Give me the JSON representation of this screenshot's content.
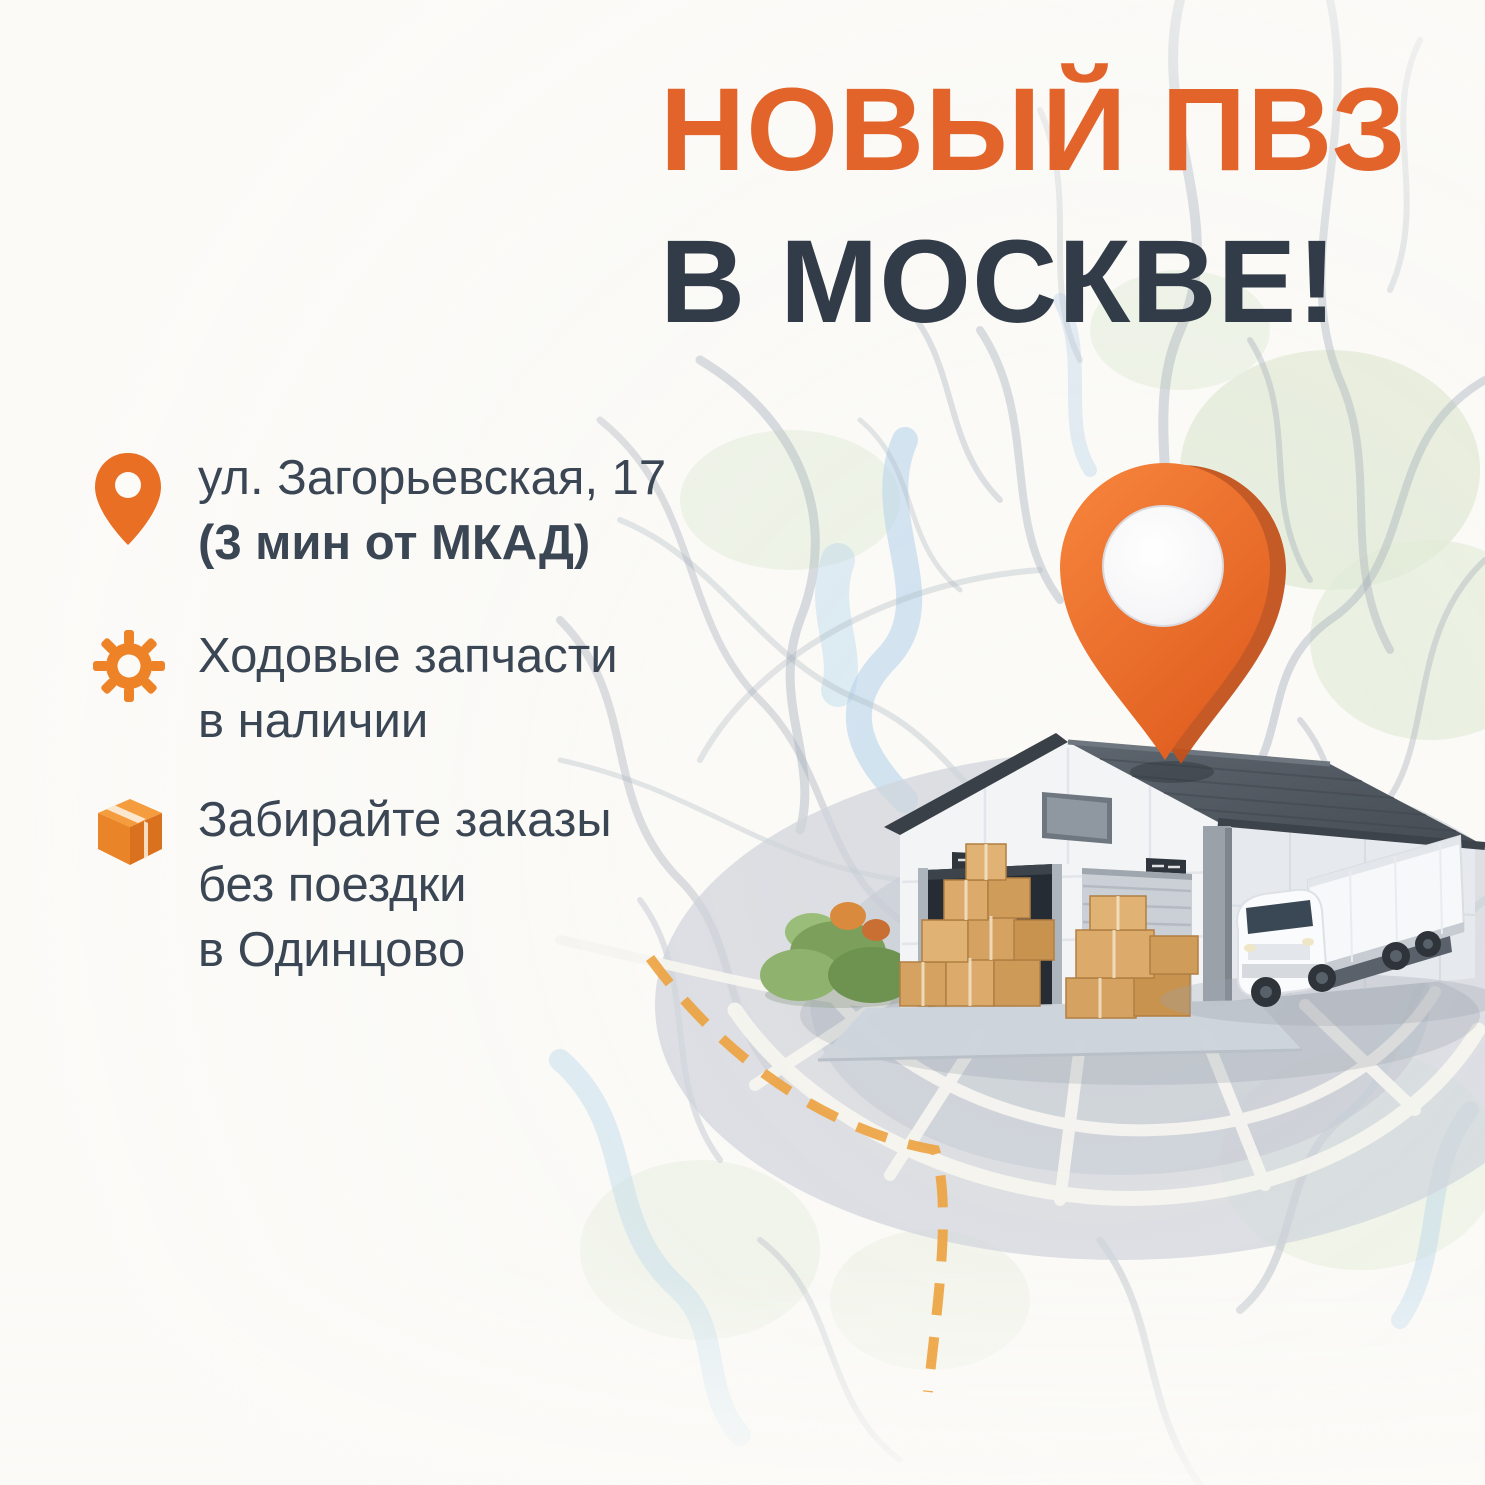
{
  "title": {
    "line1": "НОВЫЙ ПВЗ",
    "line2": "В МОСКВЕ!"
  },
  "features": {
    "address": {
      "line1": "ул. Загорьевская, 17",
      "line2": "(3 мин от МКАД)"
    },
    "parts": {
      "line1": "Ходовые запчасти",
      "line2": "в наличии"
    },
    "orders": {
      "line1": "Забирайте заказы",
      "line2": "без поездки",
      "line3": "в Одинцово"
    }
  },
  "icons": {
    "address": "location-pin-icon",
    "parts": "gear-icon",
    "orders": "package-icon",
    "map_marker": "location-pin-3d"
  },
  "colors": {
    "accent_orange": "#E2642B",
    "title_navy": "#323C48",
    "body_text": "#3B4654",
    "icon_orange": "#ED8227",
    "pin_orange": "#EE6F2D",
    "route_orange": "#ECA23E",
    "roof_slate": "#4C535B",
    "map_road_gray": "#95A1B0",
    "map_water_blue": "#A8CCE9",
    "map_green": "#DCE8D0",
    "background": "#FBFAF7"
  }
}
